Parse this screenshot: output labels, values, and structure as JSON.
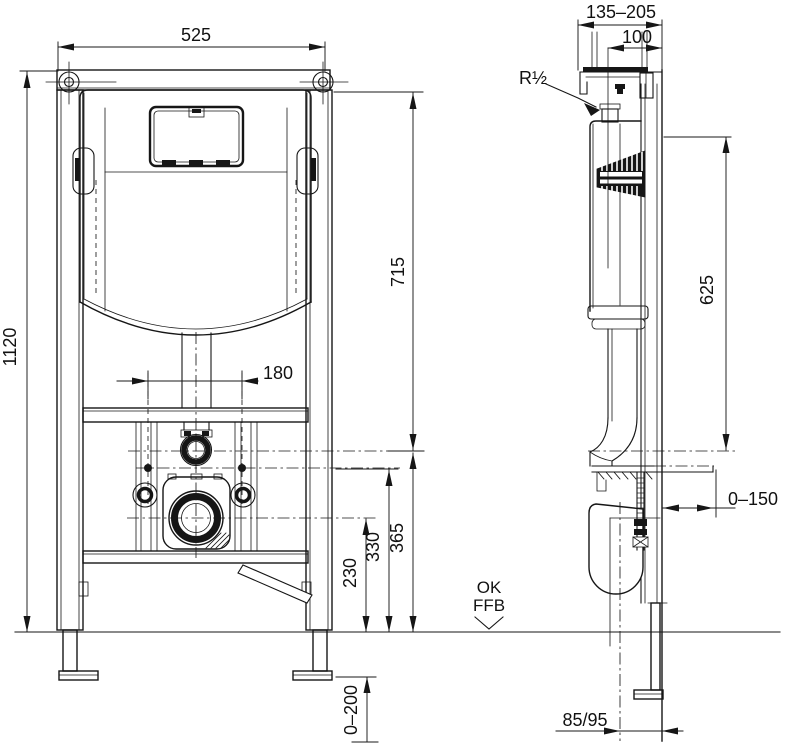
{
  "colors": {
    "ink": "#161616",
    "background": "#ffffff"
  },
  "front_view": {
    "overall_width": "525",
    "overall_height": "1120",
    "top_to_flush_axis": "715",
    "fixing_bolt_spacing": "180",
    "flush_axis_height": "365",
    "fixing_axis_height": "330",
    "drain_axis_height": "230",
    "foot_adjust_range": "0–200"
  },
  "side_view": {
    "depth_adjust_range": "135–205",
    "water_supply_offset": "100",
    "water_supply_thread": "R½",
    "supply_to_flush_axis": "625",
    "support_plate_range": "0–150",
    "drain_wall_offset": "85/95",
    "floor_marker_line1": "OK",
    "floor_marker_line2": "FFB"
  }
}
